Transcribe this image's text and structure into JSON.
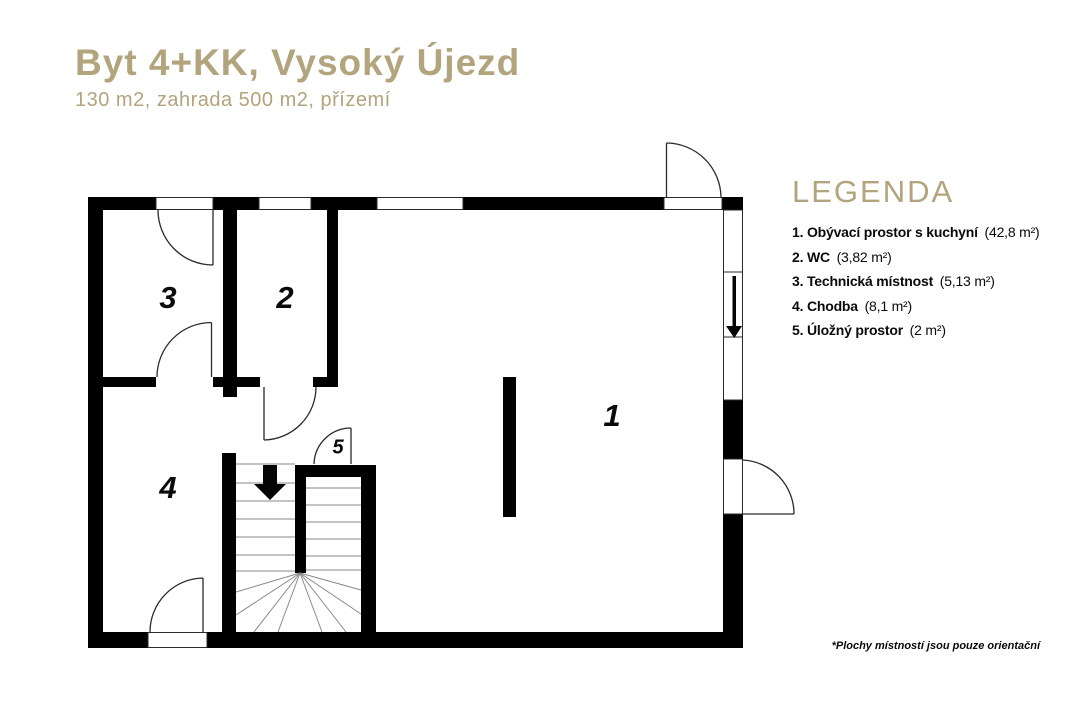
{
  "header": {
    "title": "Byt 4+KK, Vysoký Újezd",
    "subtitle": "130 m2,  zahrada 500 m2, přízemí"
  },
  "legend": {
    "title": "LEGENDA",
    "items": [
      {
        "label": "1. Obývací prostor s kuchyní",
        "area": "(42,8 m²)"
      },
      {
        "label": "2. WC",
        "area": "(3,82 m²)"
      },
      {
        "label": "3. Technická místnost",
        "area": "(5,13 m²)"
      },
      {
        "label": "4. Chodba",
        "area": "(8,1 m²)"
      },
      {
        "label": "5. Úložný prostor",
        "area": "(2 m²)"
      }
    ]
  },
  "plan": {
    "rooms": [
      {
        "number": "1"
      },
      {
        "number": "2"
      },
      {
        "number": "3"
      },
      {
        "number": "4"
      },
      {
        "number": "5"
      }
    ]
  },
  "footnote": "*Plochy místností jsou pouze orientační",
  "colors": {
    "accent": "#b2a47c",
    "wall": "#000000"
  }
}
